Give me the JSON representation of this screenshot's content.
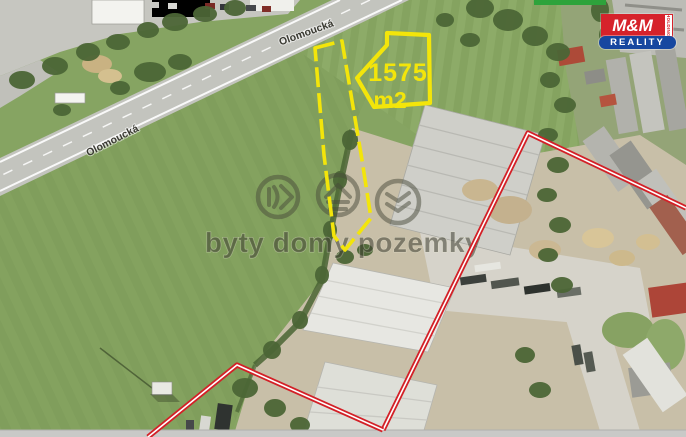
{
  "map": {
    "road_label": "Olomoucká",
    "plot": {
      "area_value": "1575",
      "area_unit": "m2"
    },
    "watermark_text": "byty domy pozemky",
    "logo": {
      "top_text": "M&M",
      "side_text": "HOLDING",
      "band_text": "REALITY"
    },
    "colors": {
      "plot_outline_yellow": "#f3e50a",
      "boundary_red": "#d32027",
      "logo_red": "#d6222b",
      "logo_blue": "#1747a0",
      "logo_green": "#2ea33b"
    }
  }
}
